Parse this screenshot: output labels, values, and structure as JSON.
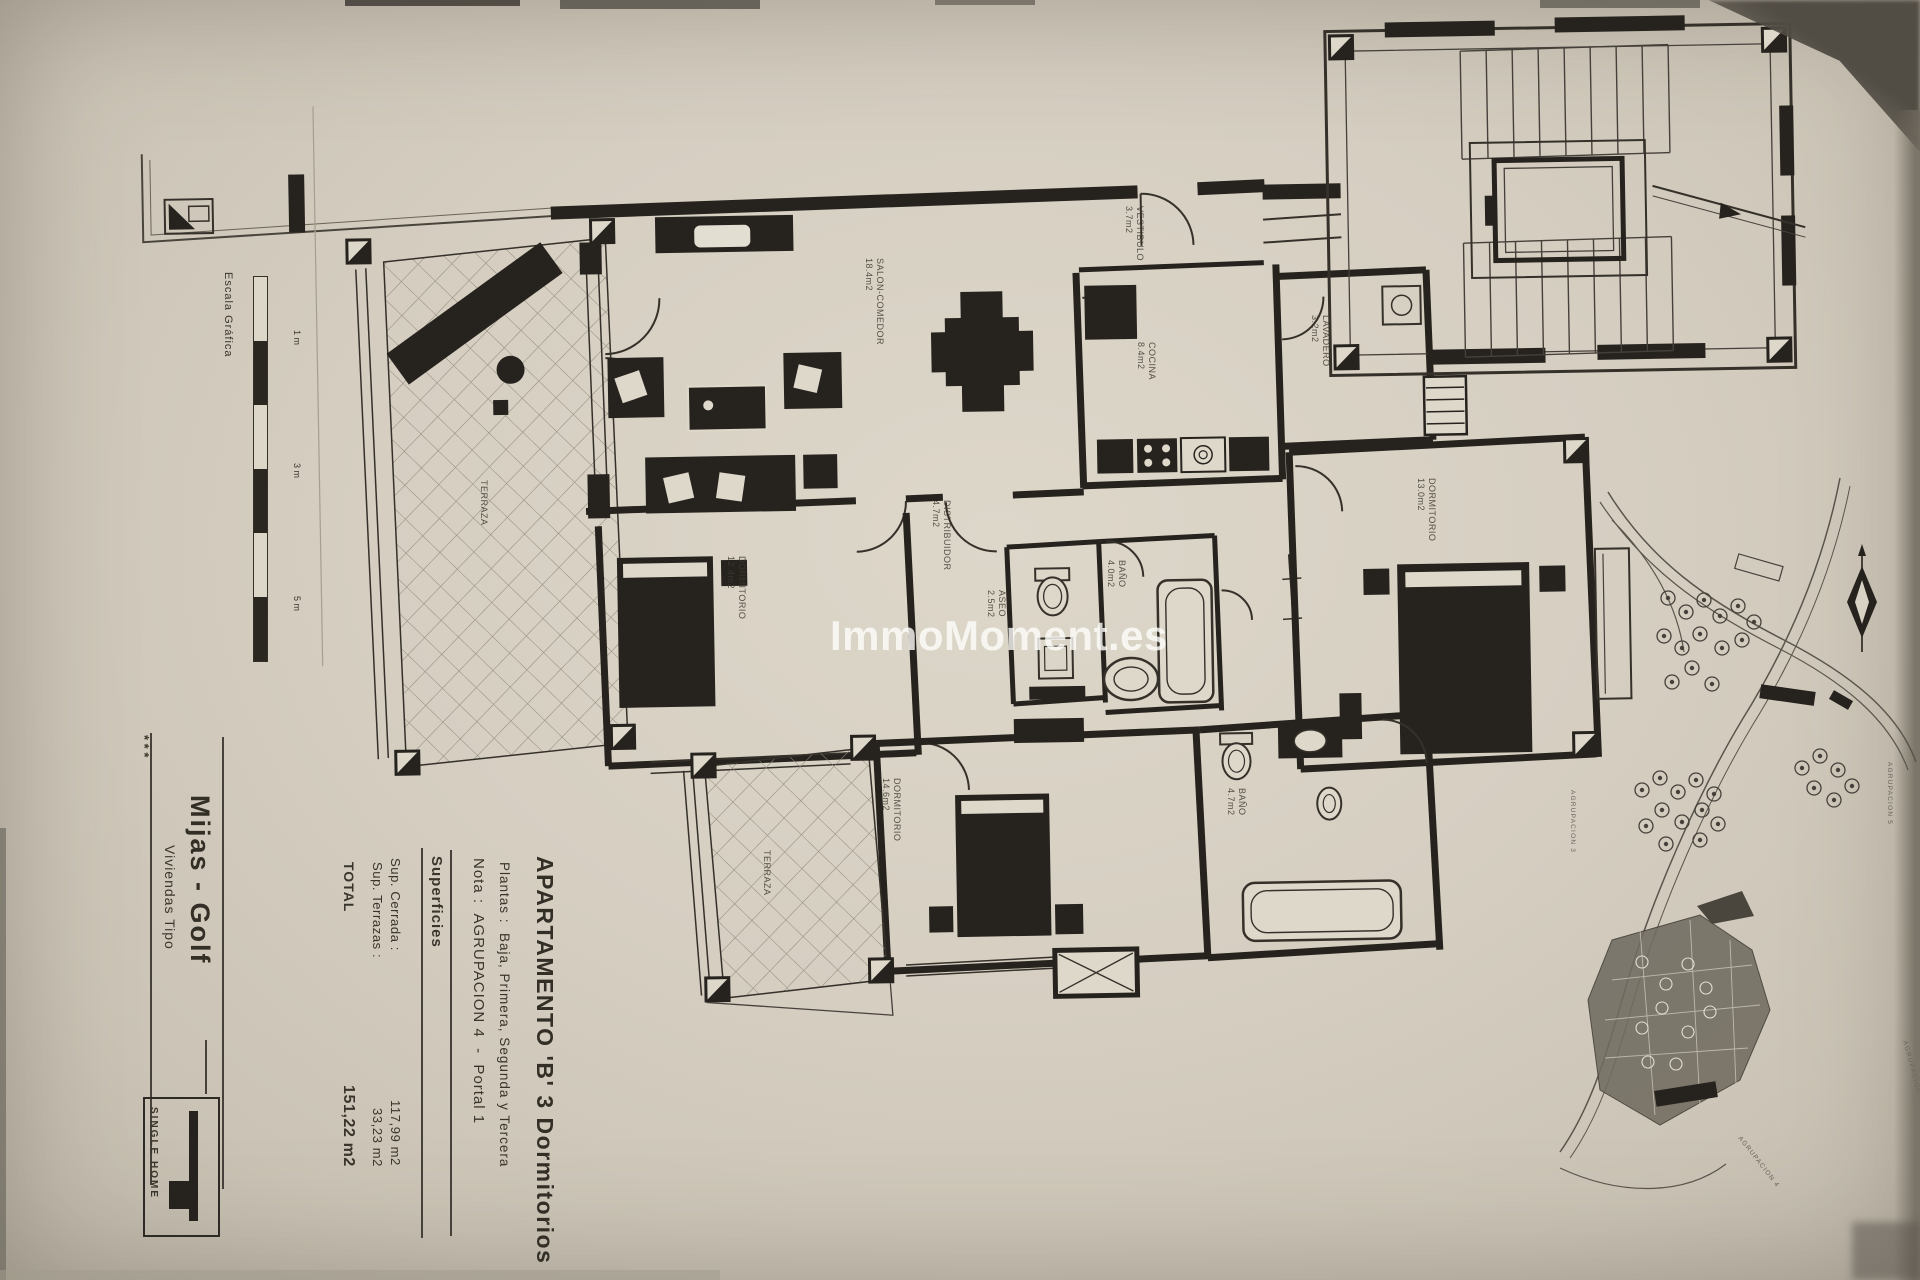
{
  "watermark": "ImmoMoment.es",
  "title_block": {
    "title": "APARTAMENTO 'B' 3 Dormitorios",
    "plantas": "Plantas :  Baja, Primera, Segunda y Tercera",
    "nota": "Nota :  AGRUPACION 4  -  Portal 1",
    "superficies_heading": "Superficies",
    "sup_cerrada_label": "Sup. Cerrada :",
    "sup_cerrada_value": "117,99 m2",
    "sup_terrazas_label": "Sup. Terrazas :",
    "sup_terrazas_value": "33,23 m2",
    "total_label": "TOTAL",
    "total_value": "151,22 m2"
  },
  "side_block": {
    "stars": "* * *",
    "location": "Mijas - Golf",
    "type_label": "Viviendas Tipo",
    "scale_label": "Escala Gráfica",
    "scale_ticks": [
      "1 m",
      "3 m",
      "5 m"
    ],
    "logo_text": "SINGLE HOME"
  },
  "rooms": [
    {
      "name": "SALON-COMEDOR",
      "area": "18.4m2"
    },
    {
      "name": "VESTIBULO",
      "area": "3.7m2"
    },
    {
      "name": "COCINA",
      "area": "8.4m2"
    },
    {
      "name": "LAVADERO",
      "area": "3.2m2"
    },
    {
      "name": "DISTRIBUIDOR",
      "area": "4.7m2"
    },
    {
      "name": "DORMITORIO",
      "area": "12.4m2"
    },
    {
      "name": "ASEO",
      "area": "2.5m2"
    },
    {
      "name": "BAÑO",
      "area": "4.0m2"
    },
    {
      "name": "DORMITORIO",
      "area": "13.0m2"
    },
    {
      "name": "DORMITORIO",
      "area": "14.6m2"
    },
    {
      "name": "BAÑO",
      "area": "4.7m2"
    },
    {
      "name": "TERRAZA",
      "area": ""
    },
    {
      "name": "TERRAZA",
      "area": ""
    }
  ],
  "site_plan": {
    "labels": [
      "AGRUPACION 3",
      "AGRUPACION 4",
      "AGRUPACION 5",
      "AGRUPACION 6"
    ]
  },
  "colors": {
    "paper": "#d6cfc2",
    "ink": "#2b2722",
    "watermark": "rgba(252,252,249,0.8)"
  }
}
